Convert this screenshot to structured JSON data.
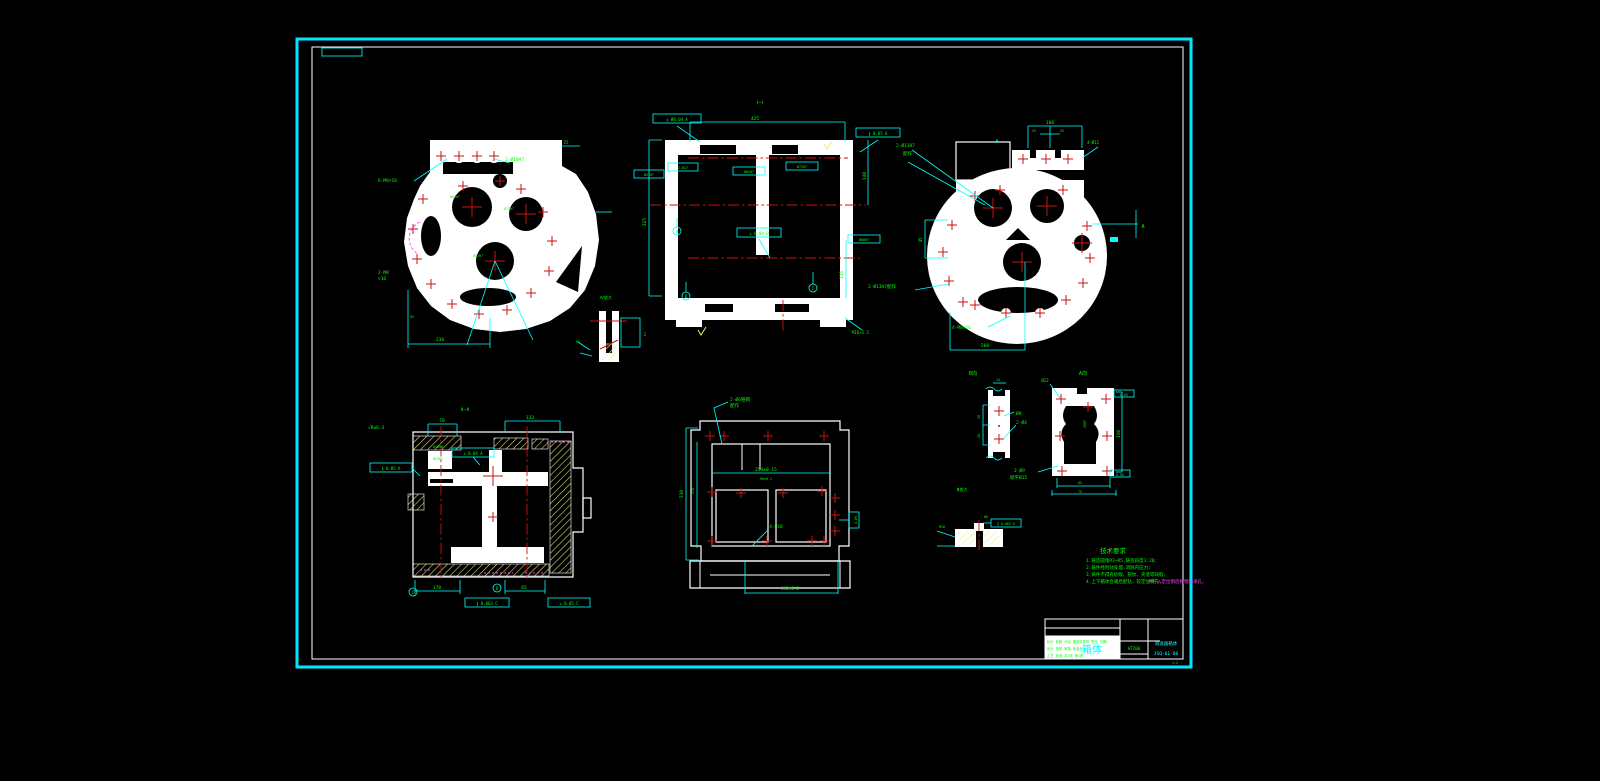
{
  "document": {
    "kind": "cad-engineering-drawing",
    "background": "#000000",
    "colors": {
      "frame": "#00e8ff",
      "geometry": "#ffffff",
      "centerline": "#cc1111",
      "dimension": "#00ffff",
      "annotation": "#00ff00",
      "hatch": "#eded70",
      "highlight": "#ff3dff"
    }
  },
  "views": {
    "left_end": {
      "labels": [
        "6-M8▽16",
        "2-Ø10H7",
        "25",
        "Ø62H7",
        "Ø72H7",
        "Ø52H7",
        "2-M8",
        "▽16",
        "230",
        "R5"
      ]
    },
    "section_i": {
      "title": "Ⅰ—Ⅰ",
      "dims": [
        "425",
        "325",
        "140",
        "115",
        "M16×1.5"
      ],
      "frames": [
        "◎ Ø0.04 A",
        "∥ 0.05 A",
        "Ø52H7",
        "2-Ø17",
        "Ø62H7",
        "Ø72H7",
        "Ø80H7",
        "⊥ 0.04 B"
      ],
      "datums": [
        "A",
        "B",
        "C"
      ]
    },
    "right_end": {
      "labels": [
        "2-Ø13H7",
        "配作",
        "100",
        "25",
        "25",
        "4-Ø11",
        "45",
        "2-Ø13H7配作",
        "4-M8▽16",
        "260",
        "A",
        "Φ"
      ]
    },
    "section_ii": {
      "title": "Ⅱ—Ⅱ",
      "dims": [
        "70",
        "132",
        "170",
        "65",
        "√Ra6.3",
        "Ø40H8",
        "Ø25H7"
      ],
      "frames": [
        "∥ 0.05 A",
        "⊥ 0.04 A",
        "∥ 0.063 C",
        "⊥ 0.05 C"
      ],
      "datums": [
        "C",
        "D"
      ]
    },
    "top_plan": {
      "labels": [
        "2-Ø6锥销",
        "配作",
        "254±0.15",
        "96±0.1",
        "230",
        "176",
        "150±0.2",
        "4-Ø18",
        "4-Ø9"
      ]
    },
    "view_b": {
      "title": "B向",
      "labels": [
        "28",
        "28",
        "Ø9",
        "2-Ø4",
        "14"
      ]
    },
    "view_a": {
      "title": "A向",
      "labels": [
        "110",
        "65",
        "75",
        "Ø12",
        "20H7",
        "2-Ø9",
        "锪平Ø15",
        "0.05",
        "0.05"
      ]
    },
    "detail_iii": {
      "title": "Ⅲ放大",
      "labels": [
        "Ø6",
        "∥ 0.063 D",
        "M10"
      ]
    },
    "detail_iv": {
      "title": "Ⅳ放大",
      "labels": [
        "2",
        "R3"
      ]
    }
  },
  "tech_requirements": {
    "title": "技术要求",
    "items": [
      "1.铸造圆角R3~R5,铸造斜度1:20;",
      "2.铸件经时效处理,消除内应力;",
      "3.铸件不得有砂眼、裂纹、夹渣等缺陷;",
      "4.上下箱体合箱后配钻、铰定位销孔,"
    ],
    "item4_highlight": "并打入定位销后精镗轴承孔。"
  },
  "title_block": {
    "part_name": "箱体",
    "material": "HT200",
    "drawing_title": "减速器箱体",
    "drawing_no": "JSQ-01-00",
    "scale_label": "1:2",
    "row1": "标记 处数 分区 更改文件号 签名 日期",
    "row2": "设计 校核 审核 标准化",
    "row3": "工艺 批准 共1张 第1张"
  }
}
